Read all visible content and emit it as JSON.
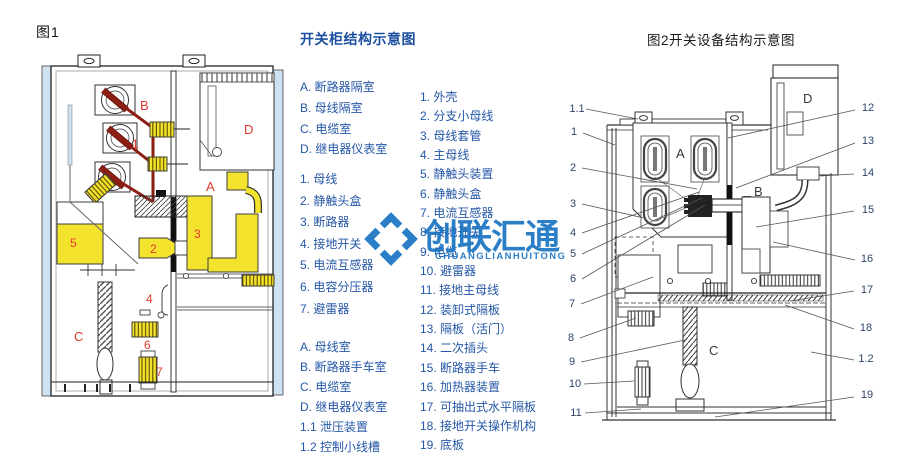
{
  "colors": {
    "blue_text": "#2557a7",
    "title_blue": "#1d4fa0",
    "label_red": "#e23b2e",
    "busbar_red": "#8c1e14",
    "part_yellow": "#f3e32d",
    "panel_blue": "#cfe2f2",
    "watermark_blue": "#1d76c2"
  },
  "fig1": {
    "caption": "图1",
    "labels": {
      "a": "A",
      "b": "B",
      "c": "C",
      "d": "D",
      "n1": "1",
      "n2": "2",
      "n3": "3",
      "n4": "4",
      "n5": "5",
      "n6": "6",
      "n7": "7"
    }
  },
  "legend_col1": {
    "title": "开关柜结构示意图",
    "group1": [
      "A. 断路器隔室",
      "B. 母线隔室",
      "C. 电缆室",
      "D. 继电器仪表室"
    ],
    "group2": [
      "1. 母线",
      "2. 静触头盒",
      "3. 断路器",
      "4. 接地开关",
      "5. 电流互感器",
      "6. 电容分压器",
      "7. 避雷器"
    ],
    "group3": [
      "A. 母线室",
      "B. 断路器手车室",
      "C. 电缆室",
      "D. 继电器仪表室",
      "1.1 泄压装置",
      "1.2 控制小线槽"
    ]
  },
  "legend_col2": {
    "items": [
      "1. 外壳",
      "2. 分支小母线",
      "3. 母线套管",
      "4. 主母线",
      "5. 静触头装置",
      "6. 静触头盒",
      "7. 电流互感器",
      "8. 接地开关",
      "9. 电缆",
      "10. 避雷器",
      "11. 接地主母线",
      "12. 装卸式隔板",
      "13. 隔板（活门）",
      "14. 二次插头",
      "15. 断路器手车",
      "16. 加热器装置",
      "17. 可抽出式水平隔板",
      "18. 接地开关操作机构",
      "19. 底板"
    ]
  },
  "fig2": {
    "caption": "图2开关设备结构示意图",
    "labels": {
      "a": "A",
      "b": "B",
      "c": "C",
      "d": "D"
    },
    "callouts_left": [
      "1.1",
      "1",
      "2",
      "3",
      "4",
      "5",
      "6",
      "7",
      "8",
      "9",
      "10",
      "11"
    ],
    "callouts_right": [
      "12",
      "13",
      "14",
      "15",
      "16",
      "17",
      "18",
      "1.2",
      "19"
    ]
  },
  "watermark": {
    "text": "创联汇通",
    "subtext": "CHUANGLIANHUITONG"
  }
}
